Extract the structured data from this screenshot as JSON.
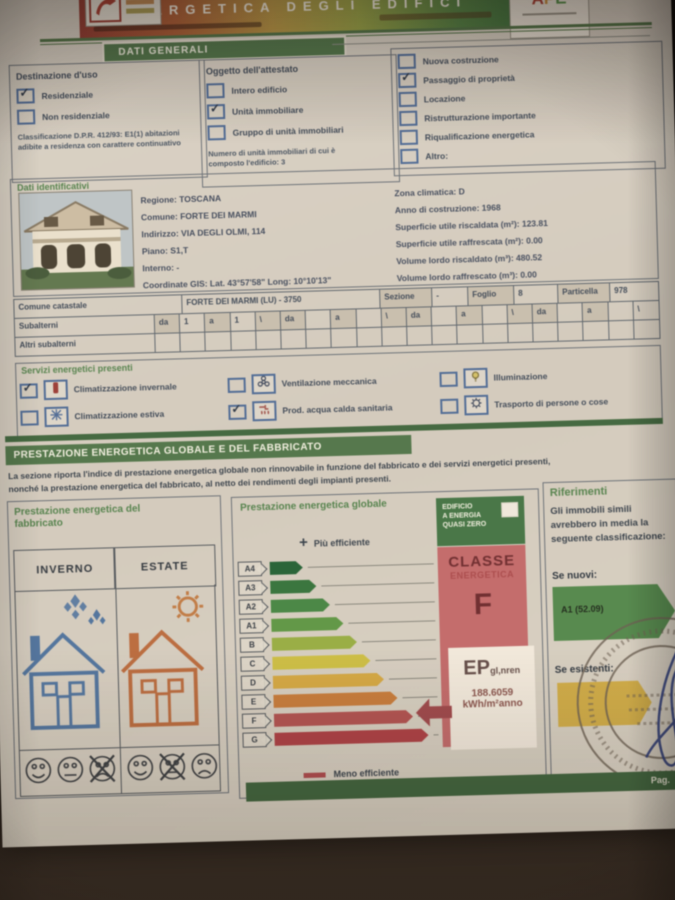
{
  "header": {
    "title_banner": "ENERGETICA DEGLI EDIFICI",
    "ape_a": "A",
    "ape_p": "P",
    "ape_e": "E"
  },
  "dati_generali": {
    "tab": "DATI GENERALI",
    "destinazione": {
      "title": "Destinazione d'uso",
      "options": [
        {
          "label": "Residenziale",
          "checked": true
        },
        {
          "label": "Non residenziale",
          "checked": false
        }
      ],
      "classificazione": "Classificazione D.P.R. 412/93: E1(1) abitazioni adibite a residenza con carattere continuativo"
    },
    "oggetto": {
      "title": "Oggetto dell'attestato",
      "options": [
        {
          "label": "Intero edificio",
          "checked": false
        },
        {
          "label": "Unità immobiliare",
          "checked": true
        },
        {
          "label": "Gruppo di unità immobiliari",
          "checked": false
        }
      ],
      "nota": "Numero di unità immobiliari di cui è composto l'edificio: 3"
    },
    "motivazioni": {
      "options": [
        {
          "label": "Nuova costruzione",
          "checked": false
        },
        {
          "label": "Passaggio di proprietà",
          "checked": true
        },
        {
          "label": "Locazione",
          "checked": false
        },
        {
          "label": "Ristrutturazione importante",
          "checked": false
        },
        {
          "label": "Riqualificazione energetica",
          "checked": false
        },
        {
          "label": "Altro:",
          "checked": false
        }
      ]
    }
  },
  "dati_identificativi": {
    "title": "Dati identificativi",
    "fields_left": [
      "Regione: TOSCANA",
      "Comune: FORTE DEI MARMI",
      "Indirizzo: VIA DEGLI OLMI, 114",
      "Piano: S1,T",
      "Interno: -",
      "Coordinate GIS: Lat. 43°57'58\" Long: 10°10'13\""
    ],
    "fields_right": [
      "Zona climatica: D",
      "Anno di costruzione: 1968",
      "Superficie utile riscaldata (m²): 123.81",
      "Superficie utile raffrescata (m²): 0.00",
      "Volume lordo riscaldato (m³): 480.52",
      "Volume lordo raffrescato (m³): 0.00"
    ]
  },
  "catasto": {
    "comune_label": "Comune catastale",
    "comune_value": "FORTE DEI MARMI (LU) - 3750",
    "sezione_label": "Sezione",
    "sezione_value": "-",
    "foglio_label": "Foglio",
    "foglio_value": "8",
    "particella_label": "Particella",
    "particella_value": "978",
    "subalterni_label": "Subalterni",
    "subalterni_groups": [
      {
        "da": "da",
        "da_val": "1",
        "a": "a",
        "a_val": "1",
        "slash": "\\"
      },
      {
        "da": "da",
        "da_val": "",
        "a": "a",
        "a_val": "",
        "slash": "\\"
      },
      {
        "da": "da",
        "da_val": "",
        "a": "a",
        "a_val": "",
        "slash": "\\"
      },
      {
        "da": "da",
        "da_val": "",
        "a": "a",
        "a_val": "",
        "slash": "\\"
      }
    ],
    "altri_label": "Altri subalterni"
  },
  "servizi": {
    "title": "Servizi energetici presenti",
    "items": [
      {
        "label": "Climatizzazione invernale",
        "checked": true,
        "icon": "thermometer-icon"
      },
      {
        "label": "Climatizzazione estiva",
        "checked": false,
        "icon": "snowflake-icon"
      },
      {
        "label": "Ventilazione meccanica",
        "checked": false,
        "icon": "fan-icon"
      },
      {
        "label": "Prod. acqua calda sanitaria",
        "checked": true,
        "icon": "hot-water-icon"
      },
      {
        "label": "Illuminazione",
        "checked": false,
        "icon": "lamp-icon"
      },
      {
        "label": "Trasporto di persone o cose",
        "checked": false,
        "icon": "elevator-icon"
      }
    ]
  },
  "prestazione": {
    "banner": "PRESTAZIONE ENERGETICA GLOBALE E DEL FABBRICATO",
    "intro_1": "La sezione riporta l'indice di prestazione energetica globale non rinnovabile in funzione del fabbricato e dei servizi energetici presenti,",
    "intro_2": "nonché la prestazione energetica del fabbricato, al netto dei rendimenti degli impianti presenti."
  },
  "fabbricato": {
    "title": "Prestazione energetica del fabbricato",
    "col_inverno": "INVERNO",
    "col_estate": "ESTATE",
    "inverno_faces": [
      {
        "mood": "happy",
        "crossed": false
      },
      {
        "mood": "neutral",
        "crossed": false
      },
      {
        "mood": "sad",
        "crossed": true
      }
    ],
    "estate_faces": [
      {
        "mood": "happy",
        "crossed": false
      },
      {
        "mood": "neutral",
        "crossed": true
      },
      {
        "mood": "sad",
        "crossed": false
      }
    ]
  },
  "globale": {
    "title": "Prestazione energetica globale",
    "plus": "+",
    "more_label": "Più efficiente",
    "less_label": "Meno efficiente",
    "nzeb_line1": "EDIFICIO",
    "nzeb_line2": "A ENERGIA",
    "nzeb_line3": "QUASI ZERO",
    "nzeb_checked": false,
    "classe_line1": "CLASSE",
    "classe_line2": "ENERGETICA",
    "classe_letter": "F",
    "ep_label": "EP",
    "ep_sub": "gl,nren",
    "ep_value": "188.6059",
    "ep_unit": "kWh/m²anno",
    "classes": [
      {
        "label": "A4",
        "color": "#1e6b35",
        "width": 33
      },
      {
        "label": "A3",
        "color": "#2e7d39",
        "width": 46
      },
      {
        "label": "A2",
        "color": "#3f8f3f",
        "width": 59
      },
      {
        "label": "A1",
        "color": "#58a03c",
        "width": 72
      },
      {
        "label": "B",
        "color": "#96b433",
        "width": 85
      },
      {
        "label": "C",
        "color": "#d2c32e",
        "width": 98
      },
      {
        "label": "D",
        "color": "#dfa930",
        "width": 111
      },
      {
        "label": "E",
        "color": "#d97b2d",
        "width": 124
      },
      {
        "label": "F",
        "color": "#c64f50",
        "width": 139
      },
      {
        "label": "G",
        "color": "#c43c44",
        "width": 154
      }
    ]
  },
  "riferimenti": {
    "title": "Riferimenti",
    "text": "Gli immobili simili avrebbero in media la seguente classificazione:",
    "nuovi_label": "Se nuovi:",
    "nuovi_value": "A1 (52.09)",
    "esistenti_label": "Se esistenti:"
  },
  "footer": {
    "page_label": "Pag."
  }
}
